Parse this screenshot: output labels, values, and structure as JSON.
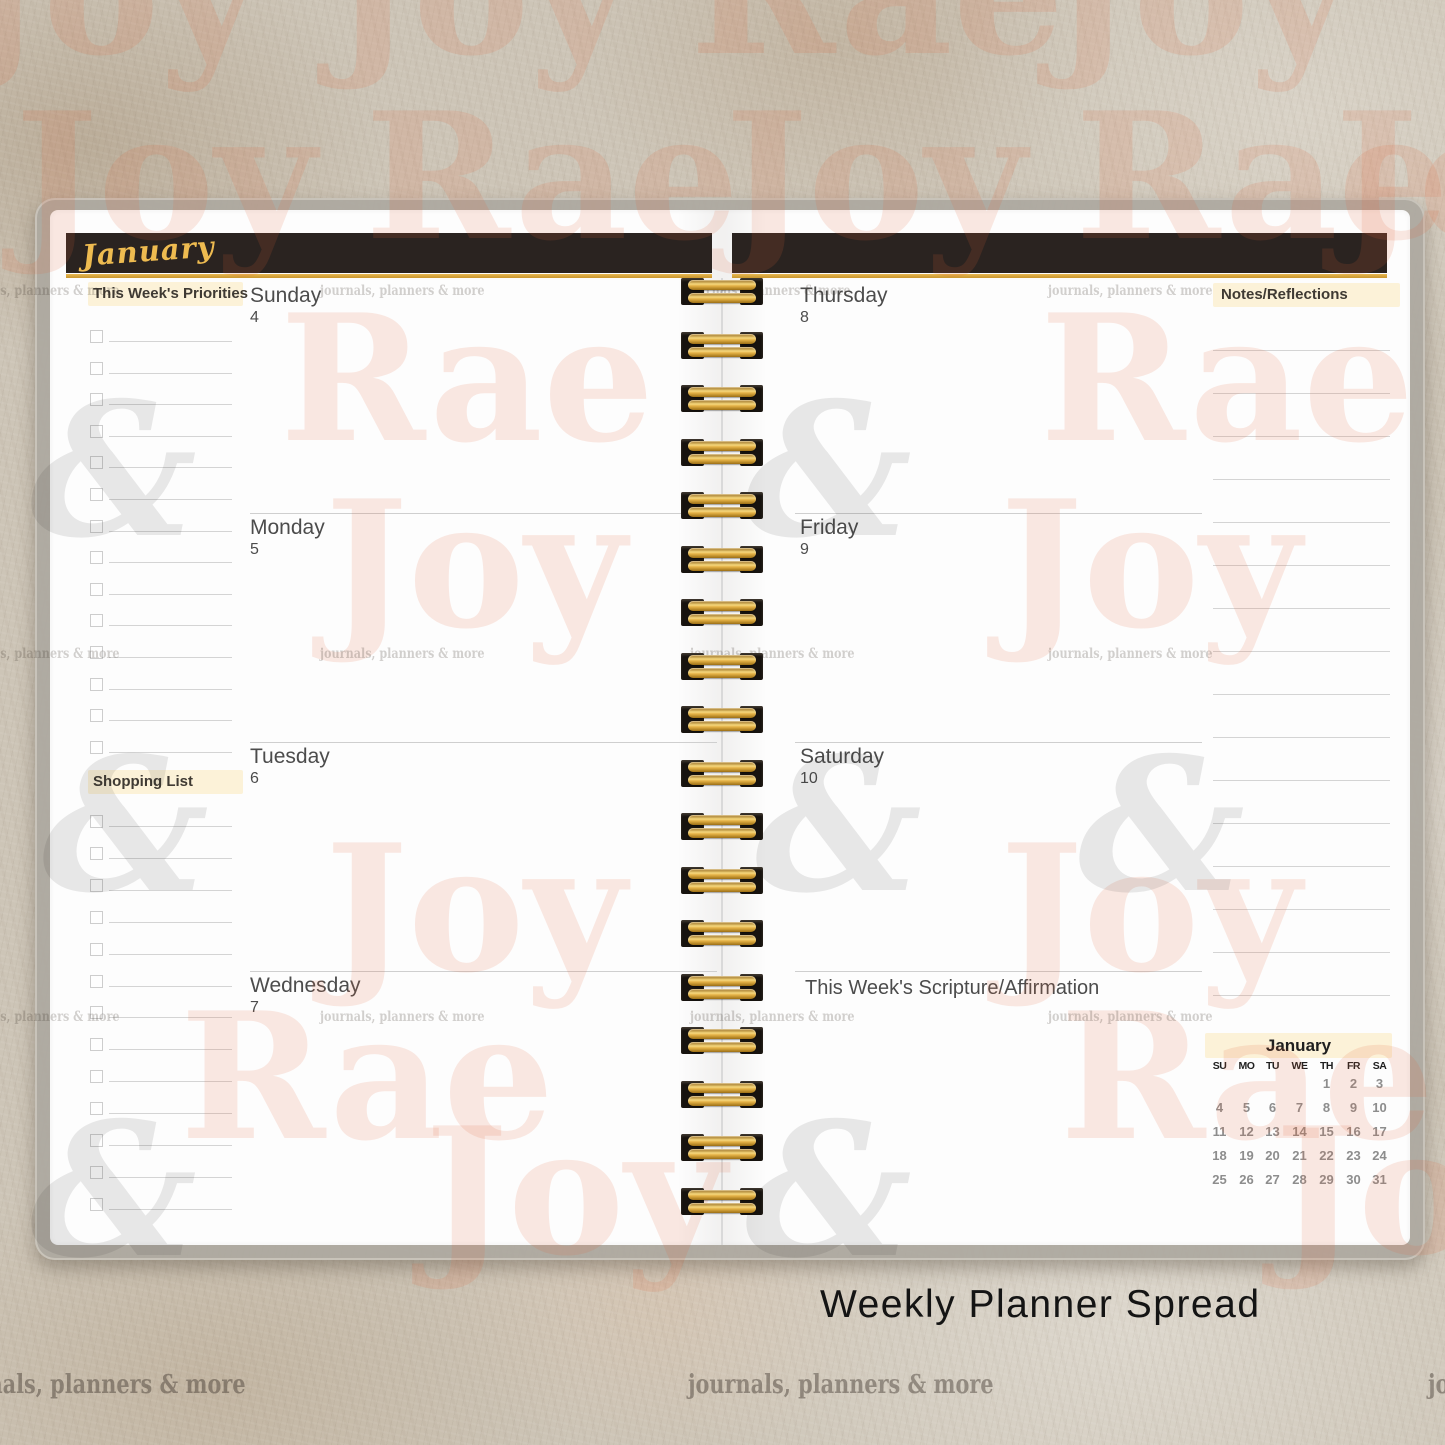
{
  "planner": {
    "month_banner": "January",
    "left_sidebar": {
      "priorities_label": "This Week's Priorities",
      "shopping_label": "Shopping List",
      "priorities_row_count": 14,
      "shopping_row_count": 13
    },
    "left_days": [
      {
        "name": "Sunday",
        "date": "4"
      },
      {
        "name": "Monday",
        "date": "5"
      },
      {
        "name": "Tuesday",
        "date": "6"
      },
      {
        "name": "Wednesday",
        "date": "7"
      }
    ],
    "right_days": [
      {
        "name": "Thursday",
        "date": "8"
      },
      {
        "name": "Friday",
        "date": "9"
      },
      {
        "name": "Saturday",
        "date": "10"
      }
    ],
    "scripture_label": "This Week's Scripture/Affirmation",
    "notes": {
      "label": "Notes/Reflections",
      "line_count": 16
    },
    "mini_calendar": {
      "title": "January",
      "day_headers": [
        "SU",
        "MO",
        "TU",
        "WE",
        "TH",
        "FR",
        "SA"
      ],
      "weeks": [
        [
          "",
          "",
          "",
          "",
          "1",
          "2",
          "3"
        ],
        [
          "4",
          "5",
          "6",
          "7",
          "8",
          "9",
          "10"
        ],
        [
          "11",
          "12",
          "13",
          "14",
          "15",
          "16",
          "17"
        ],
        [
          "18",
          "19",
          "20",
          "21",
          "22",
          "23",
          "24"
        ],
        [
          "25",
          "26",
          "27",
          "28",
          "29",
          "30",
          "31"
        ]
      ]
    }
  },
  "caption": "Weekly Planner Spread",
  "colors": {
    "banner_black": "#2a2320",
    "gold": "#dca43c",
    "script_gold": "#eebb50",
    "highlight_cream": "#fcf2d8",
    "line_gray": "#d4d4d4",
    "day_text": "#4c4c4c",
    "calendar_date_gray": "#8d8d8d",
    "watermark_pink": "rgba(226,102,60,0.14)",
    "watermark_gray": "rgba(40,40,40,0.10)"
  },
  "watermark": {
    "tagline": "journals, planners & more",
    "items": [
      {
        "t": "Joy",
        "k": "big",
        "x": -40,
        "y": -95
      },
      {
        "t": "Joy",
        "k": "big",
        "x": 330,
        "y": -95
      },
      {
        "t": "Rae",
        "k": "big",
        "x": 690,
        "y": -95
      },
      {
        "t": "Joy",
        "k": "big",
        "x": 1050,
        "y": -95
      },
      {
        "t": "Joy",
        "k": "big",
        "x": 15,
        "y": 90
      },
      {
        "t": "Rae",
        "k": "big",
        "x": 365,
        "y": 90
      },
      {
        "t": "Joy",
        "k": "big",
        "x": 725,
        "y": 90
      },
      {
        "t": "Rae",
        "k": "big",
        "x": 1075,
        "y": 90
      },
      {
        "t": "Joy",
        "k": "big",
        "x": 1335,
        "y": 90
      },
      {
        "t": "Rae",
        "k": "big",
        "x": 280,
        "y": 292
      },
      {
        "t": "Rae",
        "k": "big",
        "x": 1040,
        "y": 292
      },
      {
        "t": "Joy",
        "k": "big",
        "x": 325,
        "y": 478
      },
      {
        "t": "Joy",
        "k": "big",
        "x": 1000,
        "y": 478
      },
      {
        "t": "Joy",
        "k": "big",
        "x": 325,
        "y": 822
      },
      {
        "t": "Joy",
        "k": "big",
        "x": 1000,
        "y": 822
      },
      {
        "t": "Rae",
        "k": "big",
        "x": 180,
        "y": 990
      },
      {
        "t": "Rae",
        "k": "big",
        "x": 1060,
        "y": 990
      },
      {
        "t": "Joy",
        "k": "big",
        "x": 425,
        "y": 1105
      },
      {
        "t": "Joy",
        "k": "big",
        "x": 1275,
        "y": 1105
      },
      {
        "t": "&",
        "k": "amp",
        "x": 30,
        "y": 378
      },
      {
        "t": "&",
        "k": "amp",
        "x": 745,
        "y": 378
      },
      {
        "t": "&",
        "k": "amp",
        "x": 42,
        "y": 733
      },
      {
        "t": "&",
        "k": "amp",
        "x": 755,
        "y": 733
      },
      {
        "t": "&",
        "k": "amp",
        "x": 1078,
        "y": 733
      },
      {
        "t": "&",
        "k": "amp",
        "x": 30,
        "y": 1098
      },
      {
        "t": "&",
        "k": "amp",
        "x": 745,
        "y": 1098
      },
      {
        "t": "journals, planners & more",
        "k": "tag",
        "x": -45,
        "y": 284
      },
      {
        "t": "journals, planners & more",
        "k": "tag",
        "x": 320,
        "y": 284
      },
      {
        "t": "journals, planners & more",
        "k": "tag",
        "x": 686,
        "y": 284
      },
      {
        "t": "journals, planners & more",
        "k": "tag",
        "x": 1048,
        "y": 284
      },
      {
        "t": "journals, planners & more",
        "k": "tag",
        "x": -45,
        "y": 647
      },
      {
        "t": "journals, planners & more",
        "k": "tag",
        "x": 320,
        "y": 647
      },
      {
        "t": "journals, planners & more",
        "k": "tag",
        "x": 690,
        "y": 647
      },
      {
        "t": "journals, planners & more",
        "k": "tag",
        "x": 1048,
        "y": 647
      },
      {
        "t": "journals, planners & more",
        "k": "tag",
        "x": -45,
        "y": 1010
      },
      {
        "t": "journals, planners & more",
        "k": "tag",
        "x": 320,
        "y": 1010
      },
      {
        "t": "journals, planners & more",
        "k": "tag",
        "x": 690,
        "y": 1010
      },
      {
        "t": "journals, planners & more",
        "k": "tag",
        "x": 1048,
        "y": 1010
      },
      {
        "t": "journals, planners & more",
        "k": "tagbig",
        "x": -60,
        "y": 1372
      },
      {
        "t": "journals, planners & more",
        "k": "tagbig",
        "x": 688,
        "y": 1372
      },
      {
        "t": "journals, planners & more",
        "k": "tagbig",
        "x": 1428,
        "y": 1372
      }
    ]
  }
}
